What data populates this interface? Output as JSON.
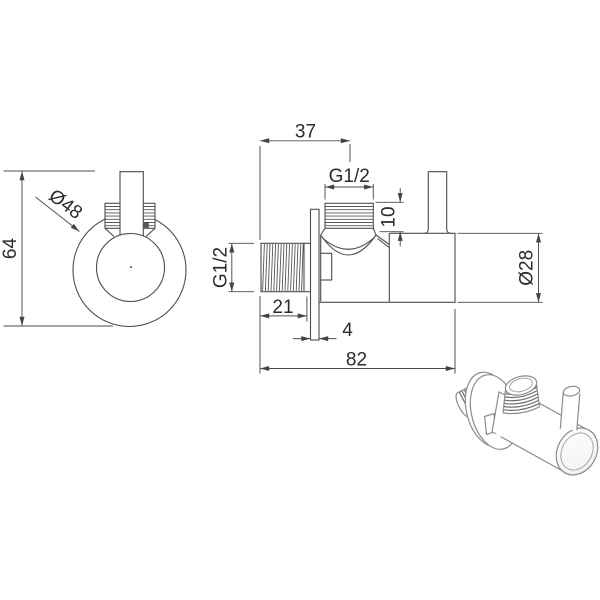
{
  "drawing": {
    "background": "#ffffff",
    "line_color": "#4d4d4d",
    "text_color": "#2b2b2b",
    "front_view": {
      "height_dim": "64",
      "flange_diameter_dim": "Ø48"
    },
    "section_view": {
      "top_port_offset_dim": "37",
      "top_port_thread_dim": "G1/2",
      "top_thread_length_dim": "10",
      "inlet_thread_dim": "G1/2",
      "inlet_thread_length_dim": "21",
      "flange_thickness_dim": "4",
      "overall_length_dim": "82",
      "body_diameter_dim": "Ø28"
    }
  }
}
